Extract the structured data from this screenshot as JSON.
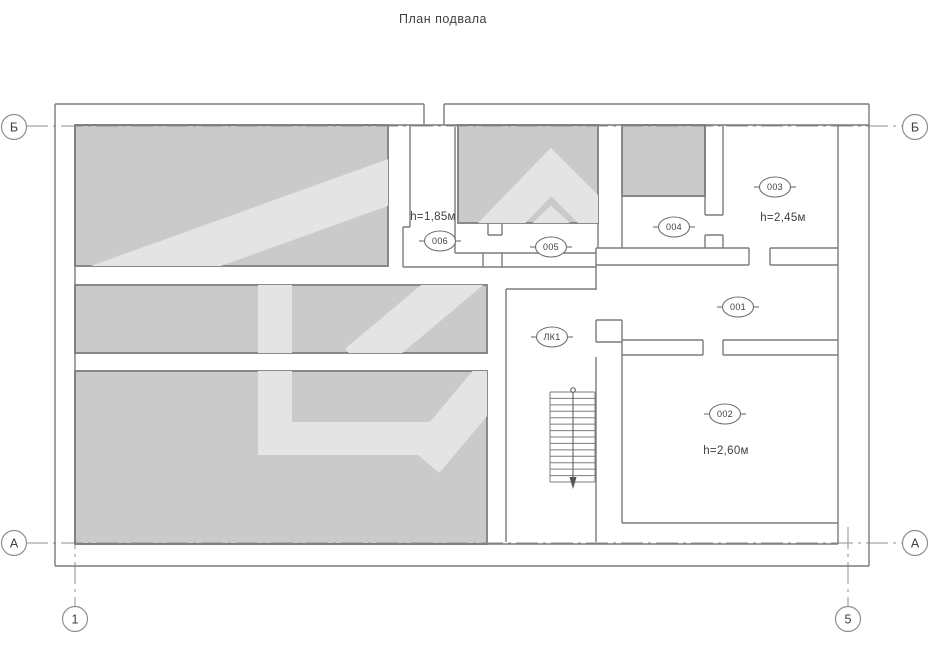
{
  "title": "План подвала",
  "axes": {
    "row_top": "Б",
    "row_bottom": "А",
    "col_first": "1",
    "col_last": "5"
  },
  "rooms": [
    {
      "number": "001"
    },
    {
      "number": "002",
      "height": "h=2,60м"
    },
    {
      "number": "003",
      "height": "h=2,45м"
    },
    {
      "number": "004"
    },
    {
      "number": "005"
    },
    {
      "number": "006",
      "height": "h=1,85м"
    }
  ],
  "stair": {
    "label": "ЛК1"
  },
  "colors": {
    "room_fill": "#cacaca",
    "room_border": "#7e7e7e",
    "wall_line": "#7b7b7b",
    "axis_line": "#8f8f8f",
    "watermark": "#e4e4e4",
    "text": "#3f3f3f"
  }
}
